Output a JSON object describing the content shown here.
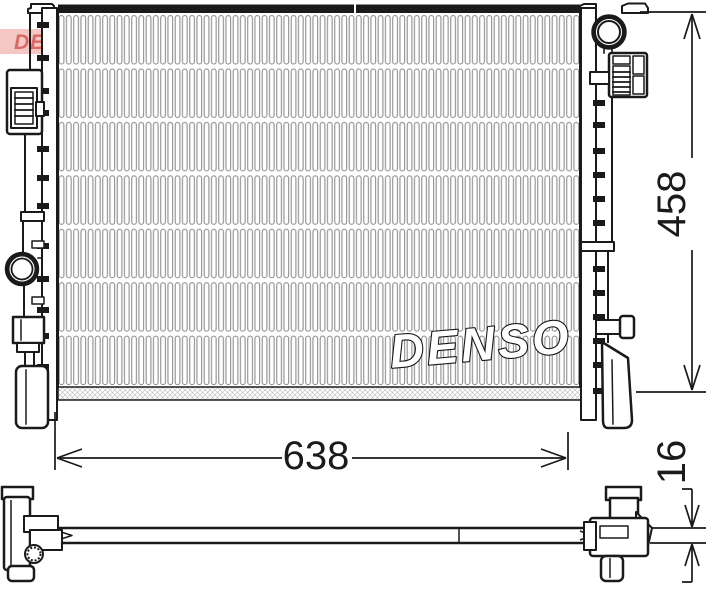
{
  "page": {
    "background": "#ffffff"
  },
  "drawing": {
    "kind": "radiator-technical-drawing",
    "center_watermark": "DENSO",
    "corner_logo_text": "DENSO",
    "dimensions": {
      "width": "638",
      "height": "458",
      "depth": "16"
    },
    "colors": {
      "line": "#1a1a1a",
      "fin": "#8f8f8f",
      "logo_red": "#cf4a45",
      "logo_band": "#f3b9b5"
    }
  }
}
